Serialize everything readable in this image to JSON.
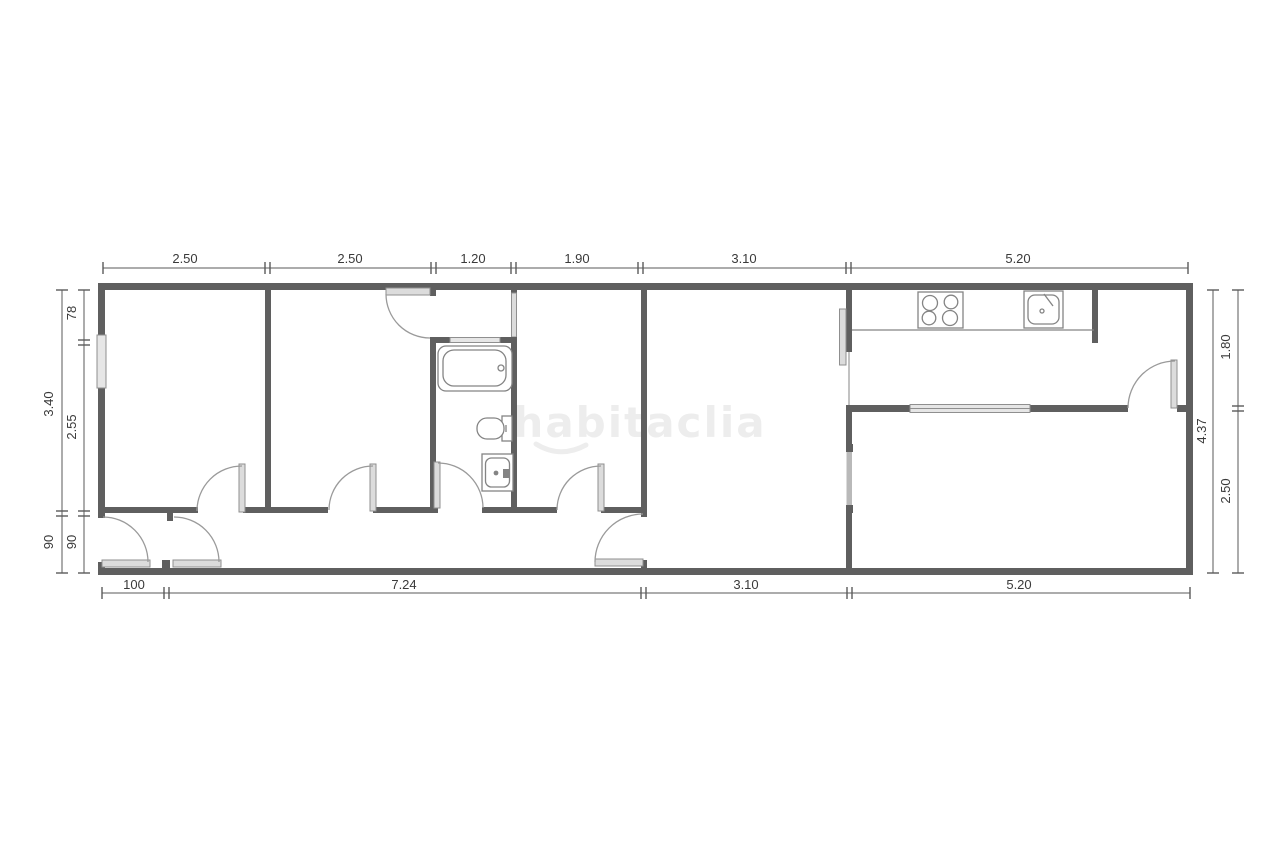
{
  "plan": {
    "watermark": {
      "text": "habitaclia"
    },
    "dimensions": {
      "top": [
        "2.50",
        "2.50",
        "1.20",
        "1.90",
        "3.10",
        "5.20"
      ],
      "bottom": [
        "100",
        "7.24",
        "3.10",
        "5.20"
      ],
      "left_outer": [
        "3.40",
        "90"
      ],
      "left_inner": [
        "78",
        "2.55",
        "90"
      ],
      "right_inner": [
        "4.37"
      ],
      "right_outer": [
        "1.80",
        "2.50"
      ]
    },
    "fixtures": {
      "bathroom": [
        "bathtub",
        "toilet",
        "washbasin"
      ],
      "kitchen": [
        "stove-cooktop",
        "kitchen-sink",
        "counter"
      ]
    },
    "colors": {
      "wall": "#5f5f5f",
      "thin_line": "#848484",
      "door_leaf": "#dcdcdc",
      "dimension_text": "#3a3a3a",
      "watermark": "#ededed",
      "background": "#ffffff"
    }
  }
}
